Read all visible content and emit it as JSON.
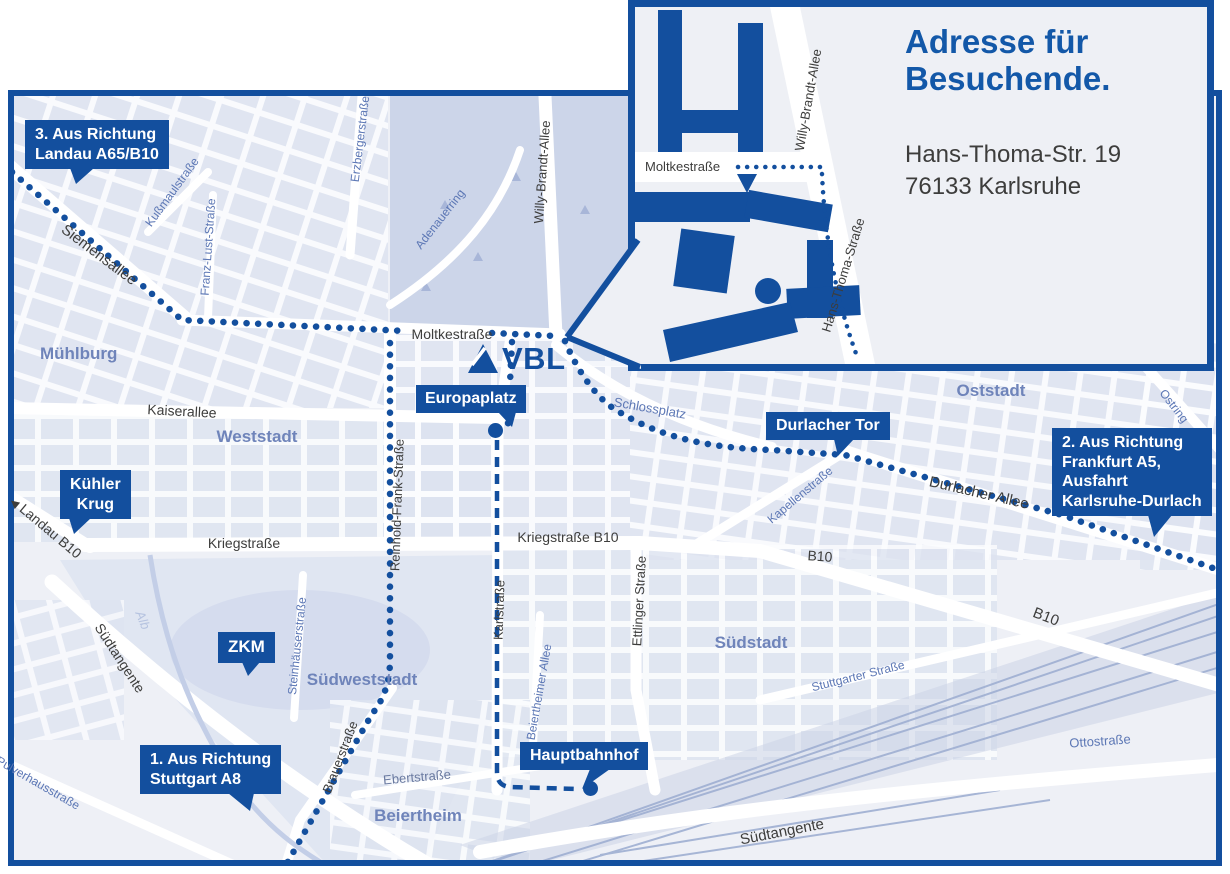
{
  "colors": {
    "primary_blue": "#134f9e",
    "heading_blue": "#1358a8",
    "map_background": "#eef0f6",
    "block_fill": "#dde3f0",
    "park_fill": "#ccd5e9",
    "district_text": "#6f84ba",
    "street_blue_text": "#5c77b5",
    "street_dark_text": "#3d3d3c",
    "water_text": "#b6c3e0"
  },
  "logo": {
    "text": "VBL"
  },
  "icons": {
    "landau_arrow": "◀",
    "moltke_entrance_arrow": "▼"
  },
  "inset": {
    "heading": "Adresse für\nBesuchende.",
    "address": "Hans-Thoma-Str. 19\n76133 Karlsruhe",
    "streets": {
      "moltkestrasse": "Moltkestraße",
      "willy_brandt_allee": "Willy-Brandt-Allee",
      "hans_thoma_strasse": "Hans-Thoma-Straße"
    }
  },
  "callouts": {
    "landau": "3. Aus Richtung\nLandau A65/B10",
    "frankfurt": "2. Aus Richtung\nFrankfurt A5,\nAusfahrt\nKarlsruhe-Durlach",
    "stuttgart": "1. Aus Richtung\nStuttgart A8",
    "kuehler_krug": "Kühler\nKrug",
    "zkm": "ZKM",
    "europaplatz": "Europaplatz",
    "durlacher_tor": "Durlacher Tor",
    "hauptbahnhof": "Hauptbahnhof"
  },
  "streets": {
    "siemensallee": "Siemensallee",
    "kussmaulstrasse": "Kußmaulstraße",
    "franz_lust_strasse": "Franz-Lust-Straße",
    "erzbergerstrasse": "Erzbergerstraße",
    "adenauerring": "Adenauerring",
    "willy_brandt_allee": "Willy-Brandt-Allee",
    "moltkestrasse": "Moltkestraße",
    "kaiserallee": "Kaiserallee",
    "reinhold_frank_strasse": "Reinhold-Frank-Straße",
    "kriegstrasse": "Kriegstraße",
    "kriegstrasse_b10": "Kriegstraße B10",
    "karlstrasse": "Karlstraße",
    "ettlinger_strasse": "Ettlinger Straße",
    "schlossplatz": "Schlossplatz",
    "kapellenstrasse": "Kapellenstraße",
    "durlacher_allee": "Durlacher Allee",
    "b10_central": "B10",
    "b10_east": "B10",
    "landau_b10": "Landau B10",
    "suedtangente_west": "Südtangente",
    "suedtangente_sued": "Südtangente",
    "steinhaeuserstrasse": "Steinhäuserstraße",
    "stuttgarter_strasse": "Stuttgarter Straße",
    "brauerstrasse": "Brauerstraße",
    "ebertstrasse": "Ebertstraße",
    "beiertheimer_allee": "Beiertheimer Allee",
    "ottostrasse": "Ottostraße",
    "ostring": "Ostring",
    "pulverhausstrasse": "Pulverhausstraße",
    "alb": "Alb"
  },
  "districts": {
    "muehlburg": "Mühlburg",
    "weststadt": "Weststadt",
    "oststadt": "Oststadt",
    "suedstadt": "Südstadt",
    "suedweststadt": "Südweststadt",
    "beiertheim": "Beiertheim"
  }
}
